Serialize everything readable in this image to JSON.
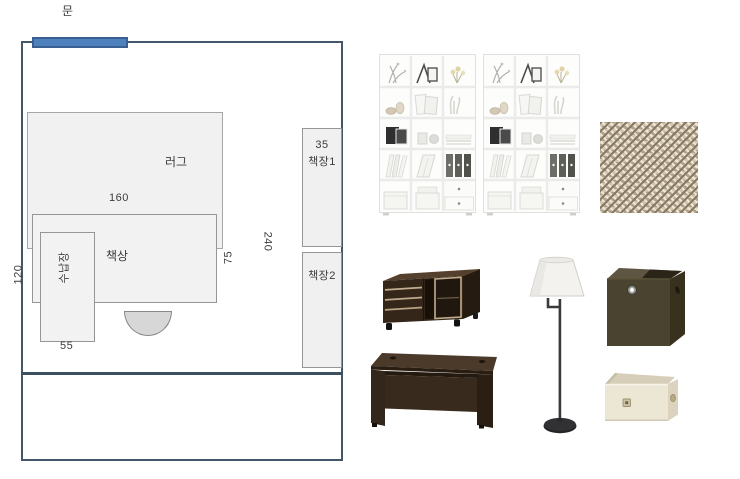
{
  "floorplan": {
    "door_label": "문",
    "rug_label": "러그",
    "rug_width": "160",
    "desk_label": "책상",
    "desk_depth": "75",
    "storage_label": "수납장",
    "storage_width": "55",
    "left_dim": "120",
    "right_dim": "240",
    "shelf_depth": "35",
    "shelf1_label": "책장1",
    "shelf2_label": "책장2"
  },
  "products": {
    "bookshelves": "white cube bookshelf pair",
    "rug_swatch": "beige woven rug texture",
    "tv_cabinet": "dark espresso sliding-door cabinet",
    "floor_lamp": "swing-arm floor lamp with white shade",
    "storage_cube": "dark brown fabric cube box",
    "desk": "dark espresso office desk",
    "cream_box": "ivory storage box"
  },
  "colors": {
    "wall_line": "#42586a",
    "door_fill": "#4f81bd",
    "door_border": "#3a5f92",
    "furniture_fill": "#f2f2f2",
    "furniture_border": "#969696",
    "chair_fill": "#d7d7d7",
    "espresso": "#34271a",
    "olive_box": "#4a432f",
    "cream_box": "#ece6d5",
    "swatch_base": "#cfc5b0"
  }
}
